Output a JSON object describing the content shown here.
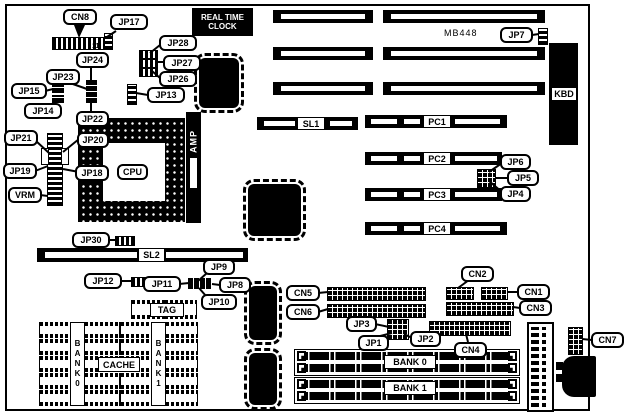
{
  "model": "MB448",
  "rtc": {
    "line1": "REAL TIME",
    "line2": "CLOCK"
  },
  "pin_marker": "11",
  "labels": {
    "cn8": "CN8",
    "jp17": "JP17",
    "jp28": "JP28",
    "jp27": "JP27",
    "jp26": "JP26",
    "jp13": "JP13",
    "jp24": "JP24",
    "jp23": "JP23",
    "jp15": "JP15",
    "jp14": "JP14",
    "jp22": "JP22",
    "jp20": "JP20",
    "jp18": "JP18",
    "jp21": "JP21",
    "jp19": "JP19",
    "vrm": "VRM",
    "jp30": "JP30",
    "jp12": "JP12",
    "jp11": "JP11",
    "jp9": "JP9",
    "jp8": "JP8",
    "jp10": "JP10",
    "jp7": "JP7",
    "jp6": "JP6",
    "jp5": "JP5",
    "jp4": "JP4",
    "jp3": "JP3",
    "jp2": "JP2",
    "jp1": "JP1",
    "cn5": "CN5",
    "cn6": "CN6",
    "cn2": "CN2",
    "cn1": "CN1",
    "cn3": "CN3",
    "cn4": "CN4",
    "cn7": "CN7",
    "kbd": "KBD",
    "cpu": "CPU",
    "amp": "AMP",
    "sl1": "SL1",
    "sl2": "SL2",
    "pc1": "PC1",
    "pc2": "PC2",
    "pc3": "PC3",
    "pc4": "PC4",
    "tag": "TAG",
    "cache": "CACHE",
    "bank0_simm": "BANK 0",
    "bank1_simm": "BANK 1",
    "bank0_cache": "BANK0",
    "bank1_cache": "BANK1"
  }
}
